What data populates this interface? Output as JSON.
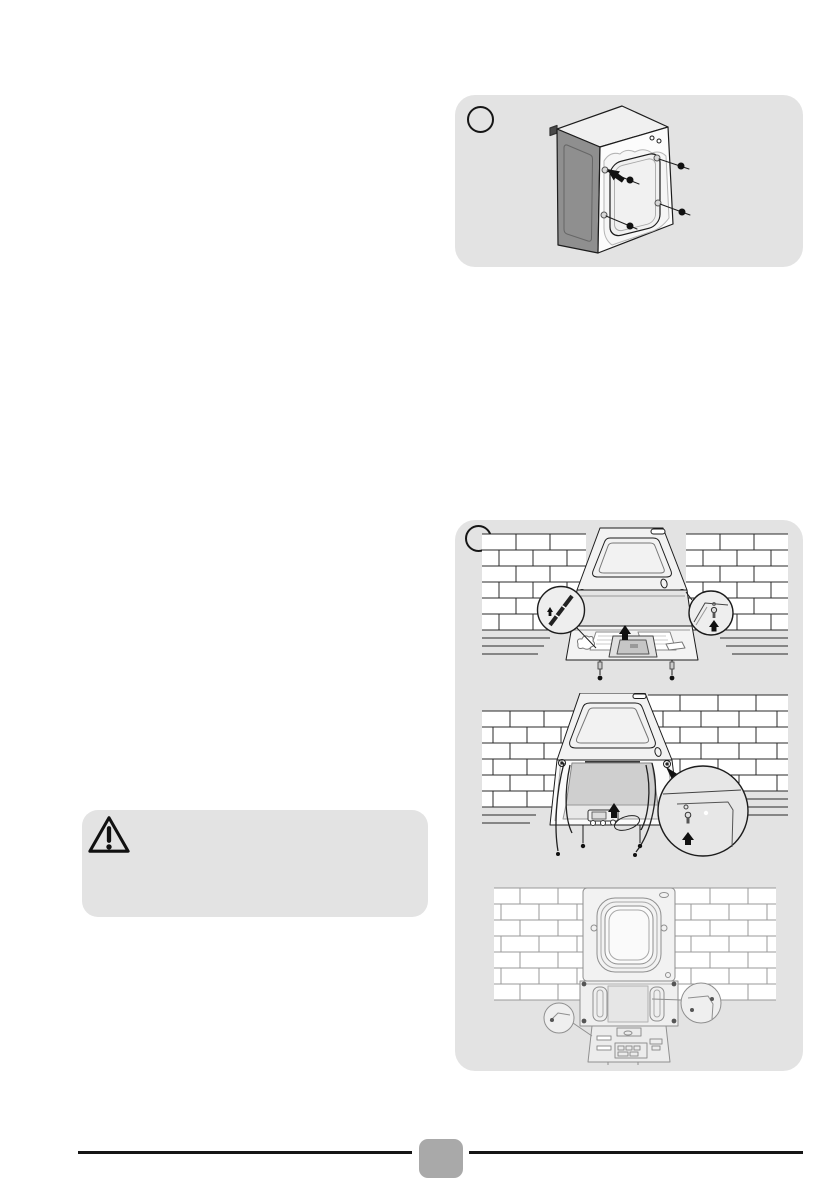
{
  "page": {
    "kind": "appliance-manual-page",
    "background": "#ffffff"
  },
  "colors": {
    "panel_background": "#e3e3e3",
    "line_ink": "#1c1c1c",
    "light_ink": "#8f8f8f",
    "machine_side_gray": "#8f8f8f",
    "badge_gray": "#a9a9a9"
  },
  "figure_top": {
    "marker_label": "",
    "illustration": "washer-rear-transit-bolts"
  },
  "figure_bottom": {
    "marker_label": "",
    "illustrations": [
      "washer-tilted-against-wall-base-packaging",
      "washer-tilted-base-removed-detail",
      "washer-rear-panel-bolt-locations"
    ]
  },
  "warning": {
    "icon": "warning-triangle-icon",
    "text": ""
  },
  "footer": {
    "page_number": ""
  }
}
